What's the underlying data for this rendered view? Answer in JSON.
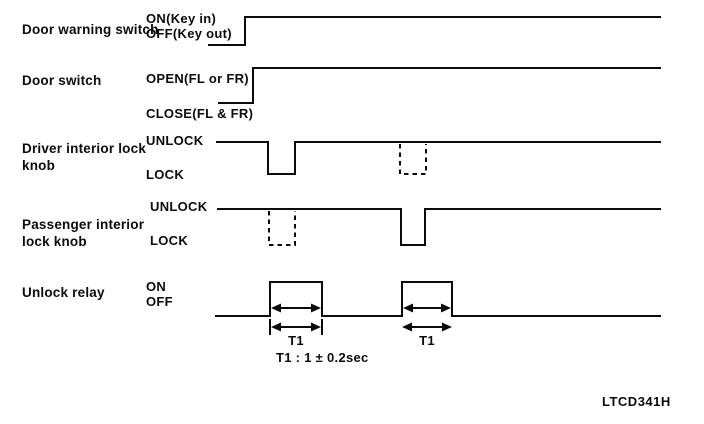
{
  "figure_code": "LTCD341H",
  "colors": {
    "ink": "#0b0b0b",
    "background": "#ffffff"
  },
  "rows": [
    {
      "label": "Door warning switch",
      "high": "ON(Key in)",
      "low": "OFF(Key out)"
    },
    {
      "label": "Door switch",
      "high": "OPEN(FL or FR)",
      "low": "CLOSE(FL & FR)"
    },
    {
      "label": "Driver interior lock knob",
      "high": "UNLOCK",
      "low": "LOCK"
    },
    {
      "label": "Passenger interior lock knob",
      "high": "UNLOCK",
      "low": "LOCK"
    },
    {
      "label": "Unlock relay",
      "high": "ON",
      "low": "OFF"
    }
  ],
  "annotations": {
    "t1_markers": [
      "T1",
      "T1"
    ],
    "t1_definition": "T1 : 1 ± 0.2sec"
  },
  "waveforms": {
    "door_warning_switch": "starts OFF(Key out), steps up to ON(Key in) and stays high",
    "door_switch": "starts CLOSE(FL & FR), steps up to OPEN(FL or FR) and stays high",
    "driver_interior_lock_knob": "UNLOCK level; solid LOCK pulse at first event, dashed LOCK pulse at second event",
    "passenger_interior_lock_knob": "UNLOCK level; dashed LOCK pulse at first event, solid LOCK pulse at second event",
    "unlock_relay": "OFF level with two ON pulses, each of width T1"
  }
}
